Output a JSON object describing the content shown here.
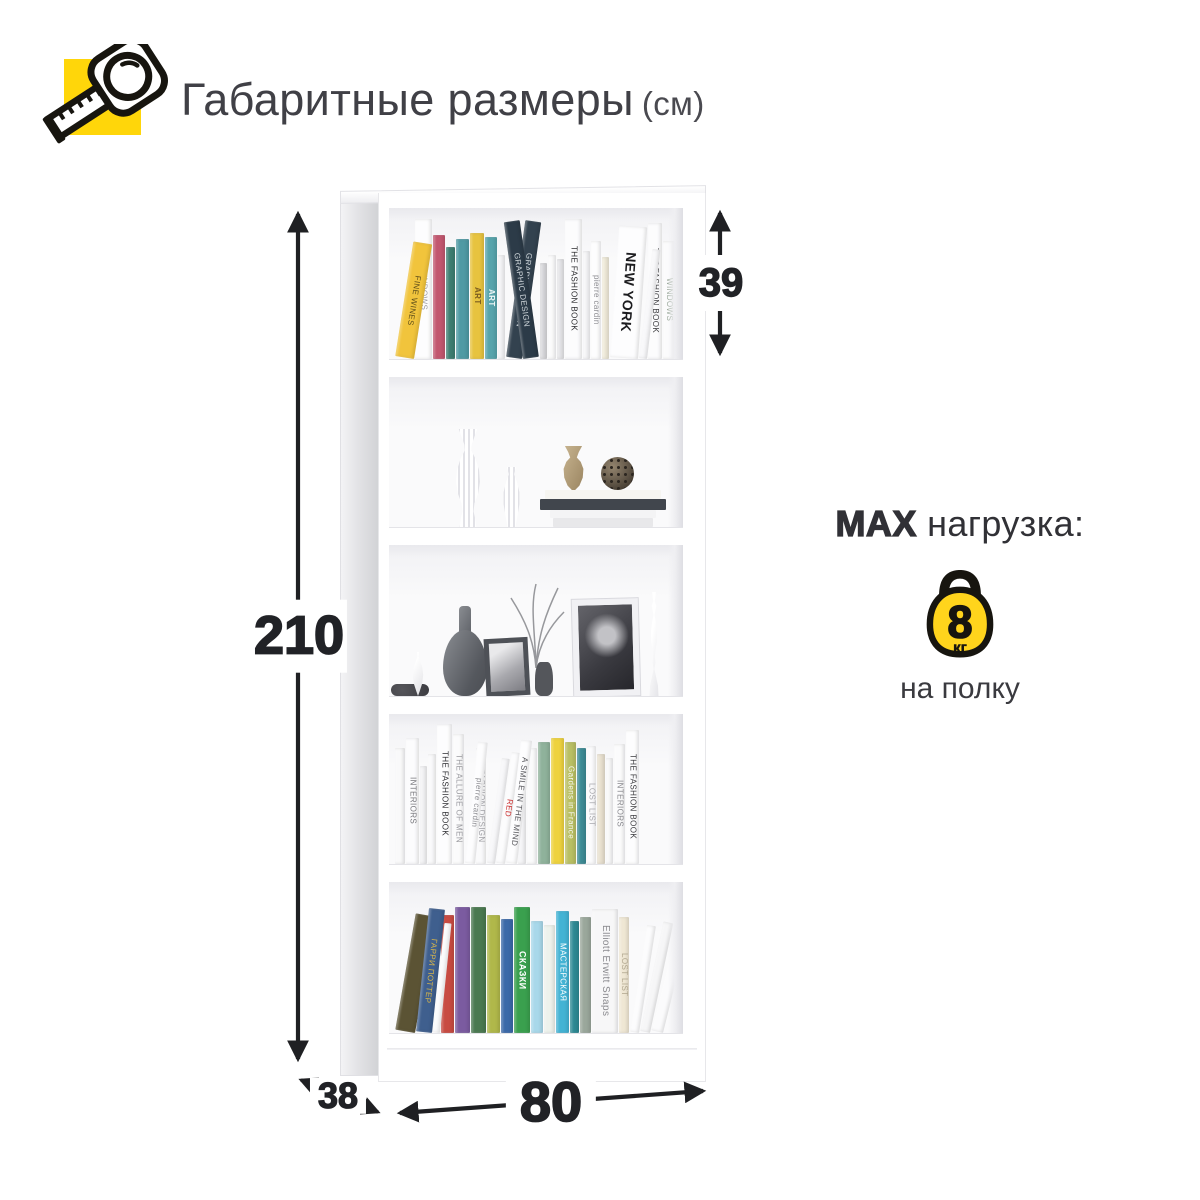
{
  "header": {
    "title": "Габаритные размеры",
    "unit": "(см)",
    "icon": "tape-measure-icon",
    "icon_bg": "#FFD60A"
  },
  "dims": {
    "height": "210",
    "shelf_height": "39",
    "width": "80",
    "depth": "38"
  },
  "max_load": {
    "bold": "MAX",
    "rest": " нагрузка:",
    "weight": "8",
    "weight_unit": "кг",
    "per": "на полку",
    "kettlebell_color": "#FFD41C"
  },
  "bookcase": {
    "color": "#ffffff",
    "shelf_count": 5,
    "shelves": [
      {
        "name": "shelf-1",
        "type": "books",
        "books": [
          {
            "c": "#f1c43c",
            "w": 19,
            "h": 116,
            "r": 9,
            "t": "FINE WINES",
            "tc": "#5d4d1a"
          },
          {
            "c": "#fdfdfe",
            "w": 17,
            "h": 140,
            "t": "WINDOWS",
            "tc": "#9a9aa0"
          },
          {
            "c": "#c2576f",
            "w": 12,
            "h": 124,
            "tc": "#ffffff"
          },
          {
            "c": "#3e7e72",
            "w": 9,
            "h": 112
          },
          {
            "c": "#4f9aa4",
            "w": 13,
            "h": 120
          },
          {
            "c": "#e7c33f",
            "w": 14,
            "h": 126,
            "t": "ART",
            "tc": "#7a5c20",
            "fw": 700
          },
          {
            "c": "#57a4ac",
            "w": 12,
            "h": 122,
            "t": "ART",
            "tc": "#eef6f6",
            "fw": 700
          },
          {
            "c": "#f4f4f6",
            "w": 7,
            "h": 104
          },
          {
            "c": "#33424f",
            "w": 16,
            "h": 138,
            "r": 8,
            "t": "GRAPHIC DESIGN",
            "tc": "#cfd6da"
          },
          {
            "c": "#2c3b48",
            "w": 16,
            "h": 138,
            "r": -8,
            "t": "GRAPHIC DESIGN",
            "tc": "#cfd6da"
          },
          {
            "c": "#d9d9dc",
            "w": 7,
            "h": 96
          },
          {
            "c": "#fbfbfc",
            "w": 8,
            "h": 104
          },
          {
            "c": "#e6e6e9",
            "w": 7,
            "h": 100
          },
          {
            "c": "#fcfcfd",
            "w": 17,
            "h": 140,
            "t": "THE FASHION BOOK",
            "tc": "#2a2a2e"
          },
          {
            "c": "#f6f6f8",
            "w": 7,
            "h": 108
          },
          {
            "c": "#fdfdfe",
            "w": 10,
            "h": 118,
            "t": "pierre cardin",
            "tc": "#8e8e93"
          },
          {
            "c": "#efead9",
            "w": 7,
            "h": 102
          },
          {
            "c": "#fdfdfe",
            "w": 28,
            "h": 132,
            "r": 4,
            "t": "NEW YORK",
            "tc": "#1c1c1f",
            "fs": 14,
            "fw": 700
          },
          {
            "c": "#f8f8fa",
            "w": 8,
            "h": 110,
            "r": 7
          },
          {
            "c": "#fcfcfd",
            "w": 14,
            "h": 136,
            "t": "THE FASHION BOOK",
            "tc": "#3a3a3e"
          },
          {
            "c": "#fbfbfc",
            "w": 12,
            "h": 118,
            "t": "WINDOWS",
            "tc": "#9aa89a"
          }
        ]
      },
      {
        "name": "shelf-2",
        "type": "decor",
        "items": [
          "tall-ribbed-vase",
          "small-ribbed-vase",
          "stacked-books",
          "tan-vase",
          "wire-ball-ornament"
        ]
      },
      {
        "name": "shelf-3",
        "type": "decor",
        "items": [
          "drop-vase",
          "dark-trinket",
          "gray-gourd-vase",
          "small-photo-frame",
          "bottle-with-twigs",
          "large-photo-frame",
          "white-candlestick"
        ]
      },
      {
        "name": "shelf-4",
        "type": "books",
        "books": [
          {
            "c": "#f9f9fa",
            "w": 10,
            "h": 116
          },
          {
            "c": "#fcfcfd",
            "w": 13,
            "h": 126,
            "t": "INTERIORS",
            "tc": "#77777c"
          },
          {
            "c": "#f3f3f5",
            "w": 7,
            "h": 98
          },
          {
            "c": "#fafafb",
            "w": 8,
            "h": 110
          },
          {
            "c": "#fdfdfe",
            "w": 15,
            "h": 140,
            "t": "THE FASHION BOOK",
            "tc": "#2c2c30"
          },
          {
            "c": "#fbfbfc",
            "w": 11,
            "h": 130,
            "t": "THE ALLURE OF MEN",
            "tc": "#9a9a9f"
          },
          {
            "c": "#fdfdfe",
            "w": 10,
            "h": 122,
            "r": 6,
            "t": "pierre cardin",
            "tc": "#8e8e93"
          },
          {
            "c": "#fafafb",
            "w": 10,
            "h": 116,
            "t": "FASHION DESIGN",
            "tc": "#a0a0a5"
          },
          {
            "c": "#f7f7f9",
            "w": 8,
            "h": 106,
            "r": 8
          },
          {
            "c": "#fcfcfd",
            "w": 9,
            "h": 112,
            "r": 8,
            "t": "RED",
            "tc": "#cc3333"
          },
          {
            "c": "#fdfdfe",
            "w": 11,
            "h": 124,
            "r": 7,
            "t": "A SMILE IN THE MIND",
            "tc": "#55555a"
          },
          {
            "c": "#f5f5f7",
            "w": 8,
            "h": 108
          },
          {
            "c": "#fbfbfc",
            "w": 10,
            "h": 116
          },
          {
            "c": "#8fb29b",
            "w": 12,
            "h": 122
          },
          {
            "c": "#eed23e",
            "w": 13,
            "h": 126
          },
          {
            "c": "#b9bf63",
            "w": 11,
            "h": 122,
            "t": "Gardens in France",
            "tc": "#f6f6ef"
          },
          {
            "c": "#3d8b95",
            "w": 9,
            "h": 116
          },
          {
            "c": "#fcfcfd",
            "w": 9,
            "h": 118,
            "t": "LOST LIST",
            "tc": "#a9a9ae"
          },
          {
            "c": "#e9e1d0",
            "w": 8,
            "h": 110
          },
          {
            "c": "#f9f9fa",
            "w": 7,
            "h": 106
          },
          {
            "c": "#fbfbfc",
            "w": 11,
            "h": 120,
            "t": "INTERIORS",
            "tc": "#88888d"
          },
          {
            "c": "#fdfdfe",
            "w": 13,
            "h": 134,
            "t": "THE FASHION BOOK",
            "tc": "#3a3a3e"
          }
        ]
      },
      {
        "name": "shelf-5",
        "type": "books",
        "books": [
          {
            "c": "#5b5334",
            "w": 20,
            "h": 118,
            "r": 10
          },
          {
            "c": "#3f5f8e",
            "w": 16,
            "h": 124,
            "r": 6,
            "t": "ГАРРИ ПОТТЕР",
            "tc": "#d9b64a"
          },
          {
            "c": "#fbfbfc",
            "w": 7,
            "h": 110,
            "r": 6
          },
          {
            "c": "#c84b42",
            "w": 13,
            "h": 118,
            "tc": "#ffffff"
          },
          {
            "c": "#7b5ba0",
            "w": 15,
            "h": 126,
            "tc": "#e8d28a"
          },
          {
            "c": "#4a7950",
            "w": 15,
            "h": 126
          },
          {
            "c": "#b0b84a",
            "w": 13,
            "h": 118
          },
          {
            "c": "#3b69a8",
            "w": 12,
            "h": 114
          },
          {
            "c": "#3aa04e",
            "w": 16,
            "h": 126,
            "t": "СКАЗКИ",
            "tc": "#ffffff",
            "fw": 700,
            "fs": 9
          },
          {
            "c": "#a8d8ea",
            "w": 12,
            "h": 112
          },
          {
            "c": "#edf2ec",
            "w": 11,
            "h": 108
          },
          {
            "c": "#43b3d4",
            "w": 13,
            "h": 122,
            "t": "МАСТЕРСКАЯ",
            "tc": "#ffffff"
          },
          {
            "c": "#2d8a94",
            "w": 9,
            "h": 112
          },
          {
            "c": "#9aa79b",
            "w": 11,
            "h": 116
          },
          {
            "c": "#f7f7f8",
            "w": 26,
            "h": 124,
            "t": "Elliott Erwitt Snaps",
            "tc": "#8b8b8f",
            "fs": 10
          },
          {
            "c": "#efe7d4",
            "w": 10,
            "h": 116,
            "t": "LOST LIST",
            "tc": "#b0a68e"
          },
          {
            "c": "#fcfcfd",
            "w": 9,
            "h": 108,
            "r": 9
          },
          {
            "c": "#f6f6f7",
            "w": 10,
            "h": 112,
            "r": 12
          },
          {
            "c": "#fbfbfc",
            "w": 12,
            "h": 104,
            "r": 14
          }
        ]
      }
    ]
  }
}
